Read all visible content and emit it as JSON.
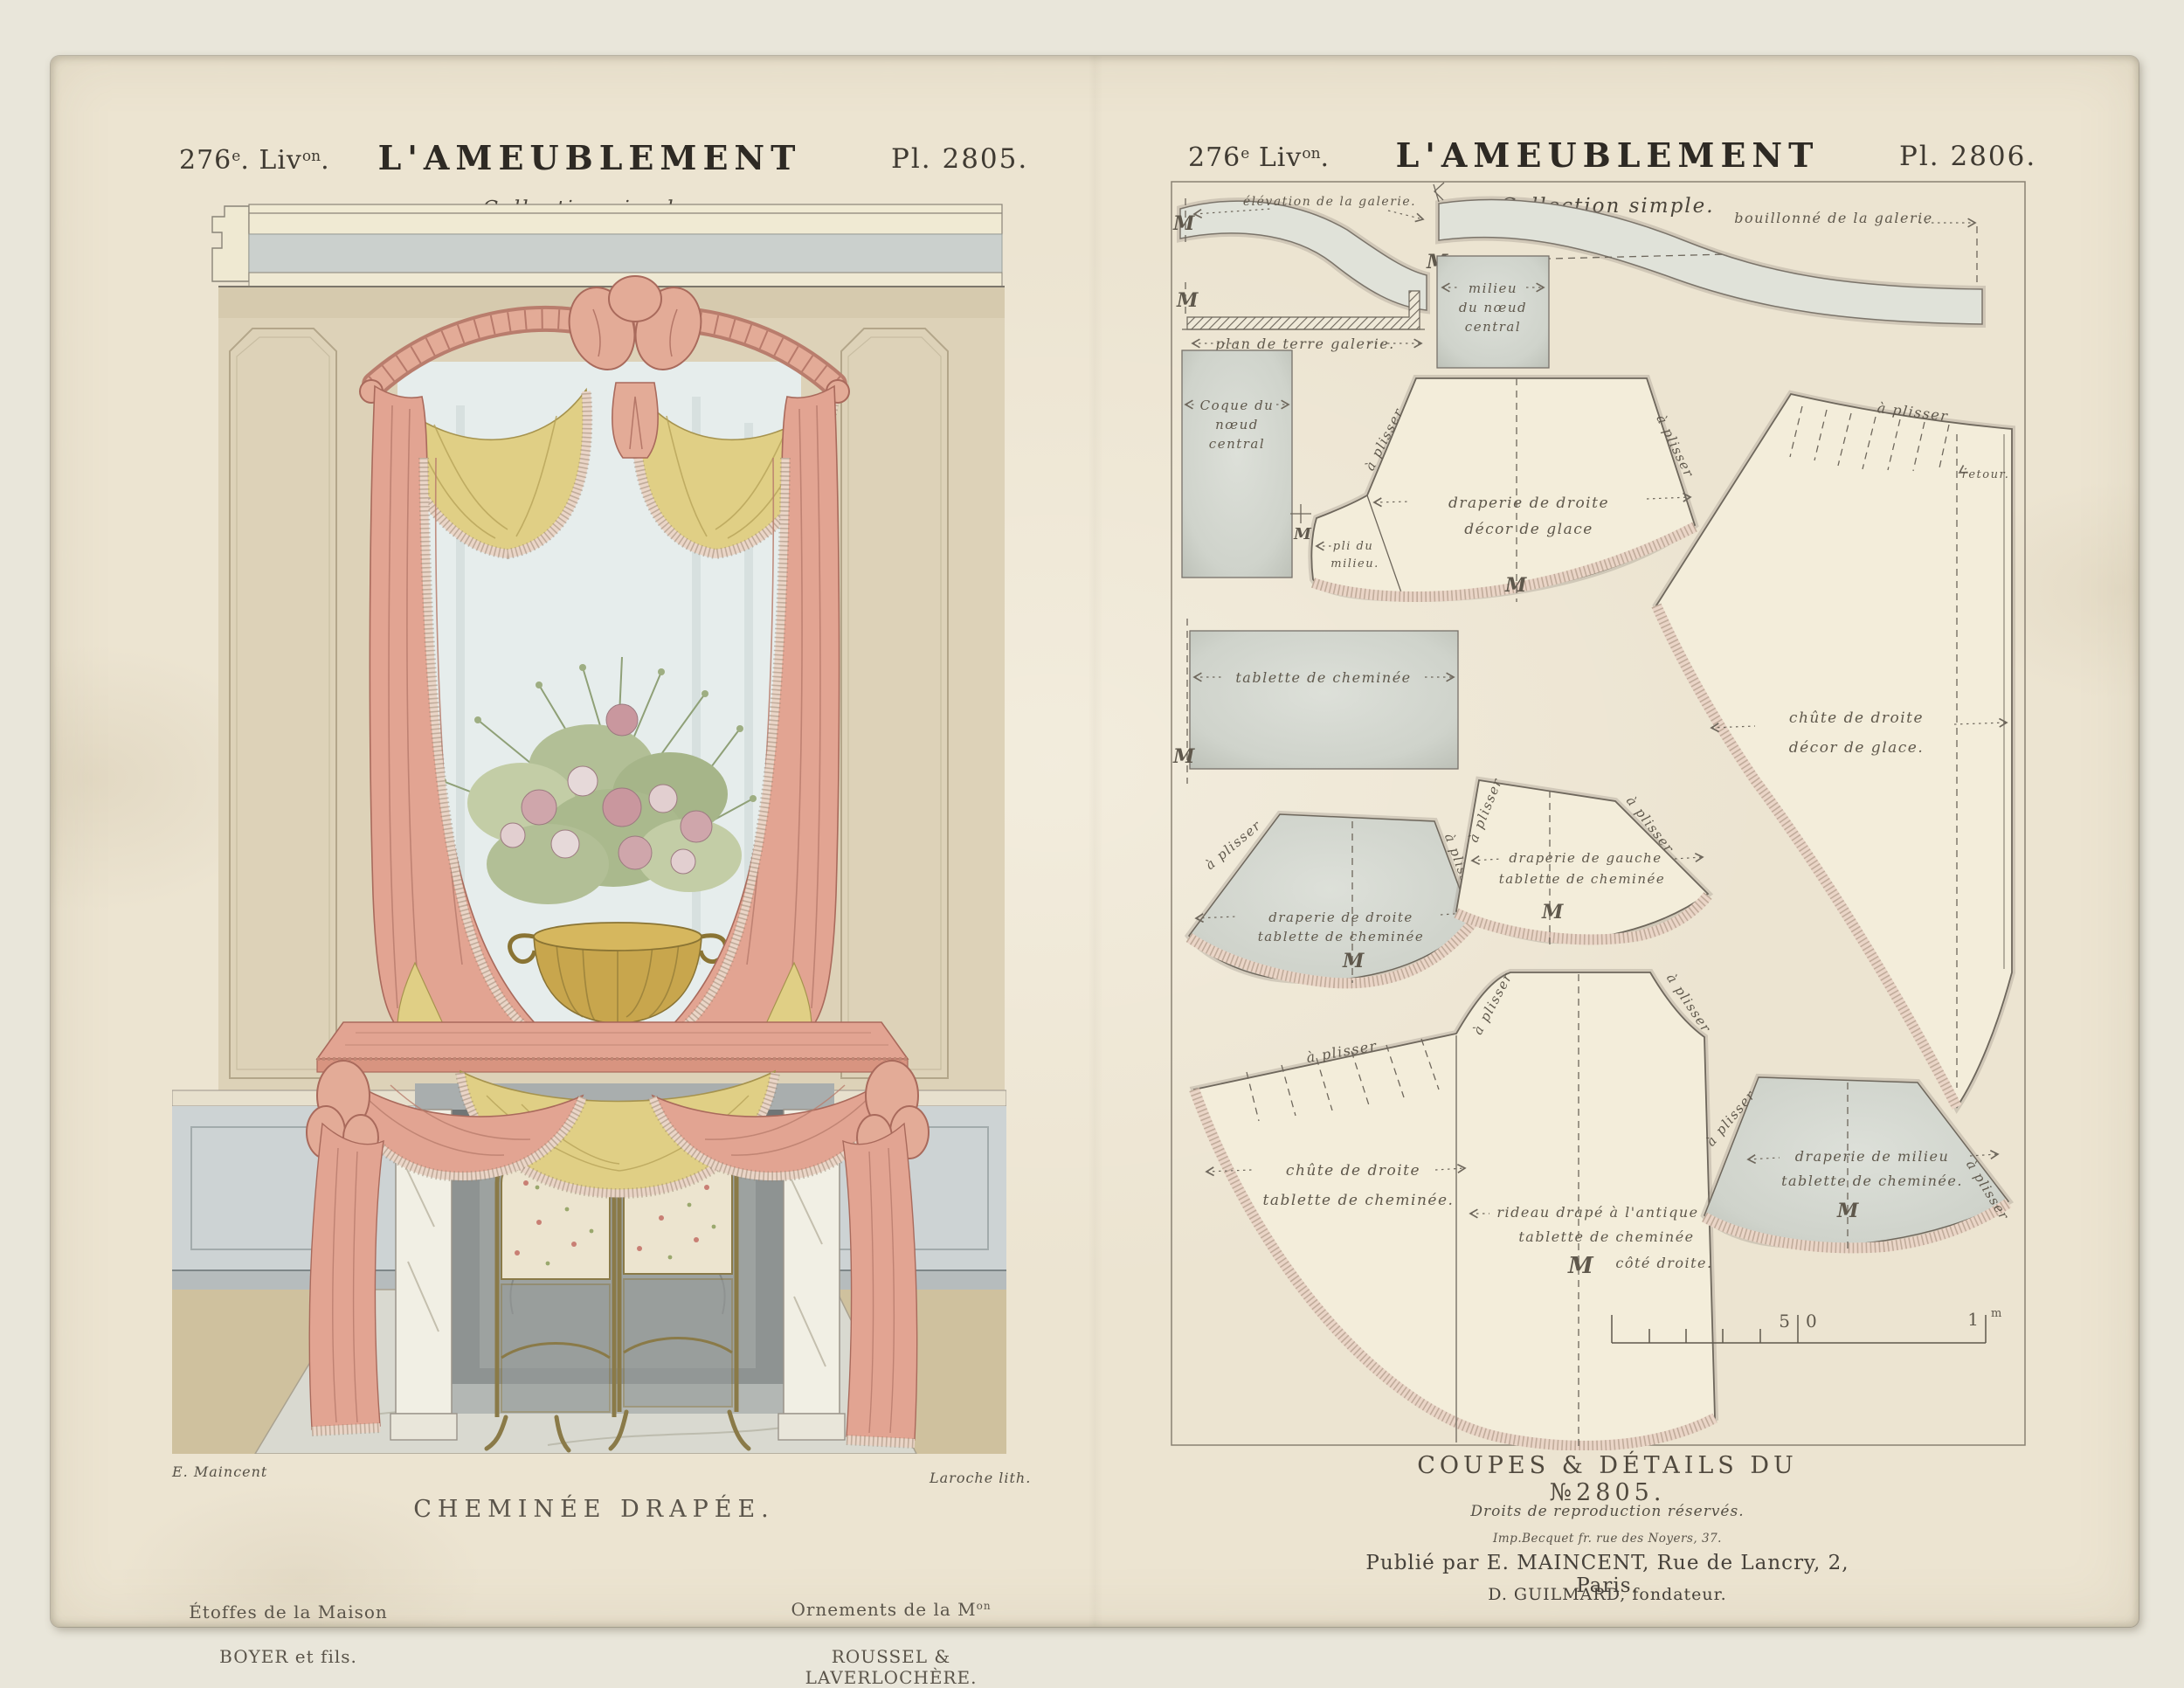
{
  "palette": {
    "backdrop": "#e9e6da",
    "paper": "#ece4d1",
    "ink": "#5f584c",
    "ink2": "#6e675c",
    "cream": "#f3edda",
    "gray_piece": "#d3d6cf",
    "fringe": "#ead5c7",
    "pink": "#e2a492",
    "pink_dark": "#a96a5c",
    "yellow": "#e0cf85",
    "wall": "#ddd2b8",
    "wainscot": "#cdd3d4",
    "mirror": "#e6edec",
    "floor": "#cfc19e",
    "marble": "#f1efe4",
    "gold": "#c8a64d"
  },
  "left_plate": {
    "header": {
      "livraison_num": "276",
      "livraison_sup1": "e",
      "livraison_mid": ". Liv",
      "livraison_sup2": "on",
      "livraison_end": ".",
      "title": "L'AMEUBLEMENT",
      "subtitle": "Collection simple.",
      "plate": "Pl. 2805."
    },
    "captions": {
      "artist": "E. Maincent",
      "lith": "Laroche lith.",
      "title": "CHEMINÉE DRAPÉE.",
      "credit_left1": "Étoffes de la Maison",
      "credit_left2": "BOYER et fils.",
      "credit_right1": "Ornements de la M",
      "credit_right1_sup": "on",
      "credit_right2": "ROUSSEL & LAVERLOCHÈRE."
    }
  },
  "right_plate": {
    "header": {
      "livraison_num": "276",
      "livraison_sup1": "e",
      "livraison_mid": " Liv",
      "livraison_sup2": "on",
      "livraison_end": ".",
      "title": "L'AMEUBLEMENT",
      "subtitle": "Collection simple.",
      "plate": "Pl. 2806."
    },
    "labels": {
      "elevation": "élévation de la galerie.",
      "bouillonne": "bouillonné de la galerie",
      "plan_terre": "plan de terre galerie.",
      "milieu_noeud": [
        "milieu",
        "du nœud",
        "central"
      ],
      "coque": [
        "Coque du",
        "nœud",
        "central"
      ],
      "a_plisser": "à plisser",
      "drap_droite_glace": [
        "draperie  de  droite",
        "décor   de  glace"
      ],
      "pli_milieu": [
        "pli du",
        "milieu."
      ],
      "retour": "retour.",
      "tablette": "tablette de cheminée",
      "chute_glace": [
        "chûte de droite",
        "décor de glace."
      ],
      "drap_gauche": [
        "draperie de gauche",
        "tablette de cheminée"
      ],
      "drap_droite_tablette": [
        "draperie de droite",
        "tablette de cheminée"
      ],
      "chute_tablette": [
        "chûte  de  droite",
        "tablette de cheminée."
      ],
      "rideau": [
        "rideau drapé à l'antique",
        "tablette de cheminée",
        "côté droite."
      ],
      "drap_milieu": [
        "draperie  de  milieu",
        "tablette  de  cheminée."
      ],
      "m_mark": "M"
    },
    "scale": {
      "mid_left": "5",
      "mid_right": "0",
      "end_num": "1",
      "unit": "m"
    },
    "captions": {
      "title": "COUPES & DÉTAILS DU №2805.",
      "rights": "Droits de reproduction réservés.",
      "printer": "Imp.Becquet fr. rue des Noyers, 37.",
      "publisher": "Publié par E. MAINCENT, Rue de Lancry, 2, Paris.",
      "founder": "D. GUILMARD, fondateur."
    }
  }
}
